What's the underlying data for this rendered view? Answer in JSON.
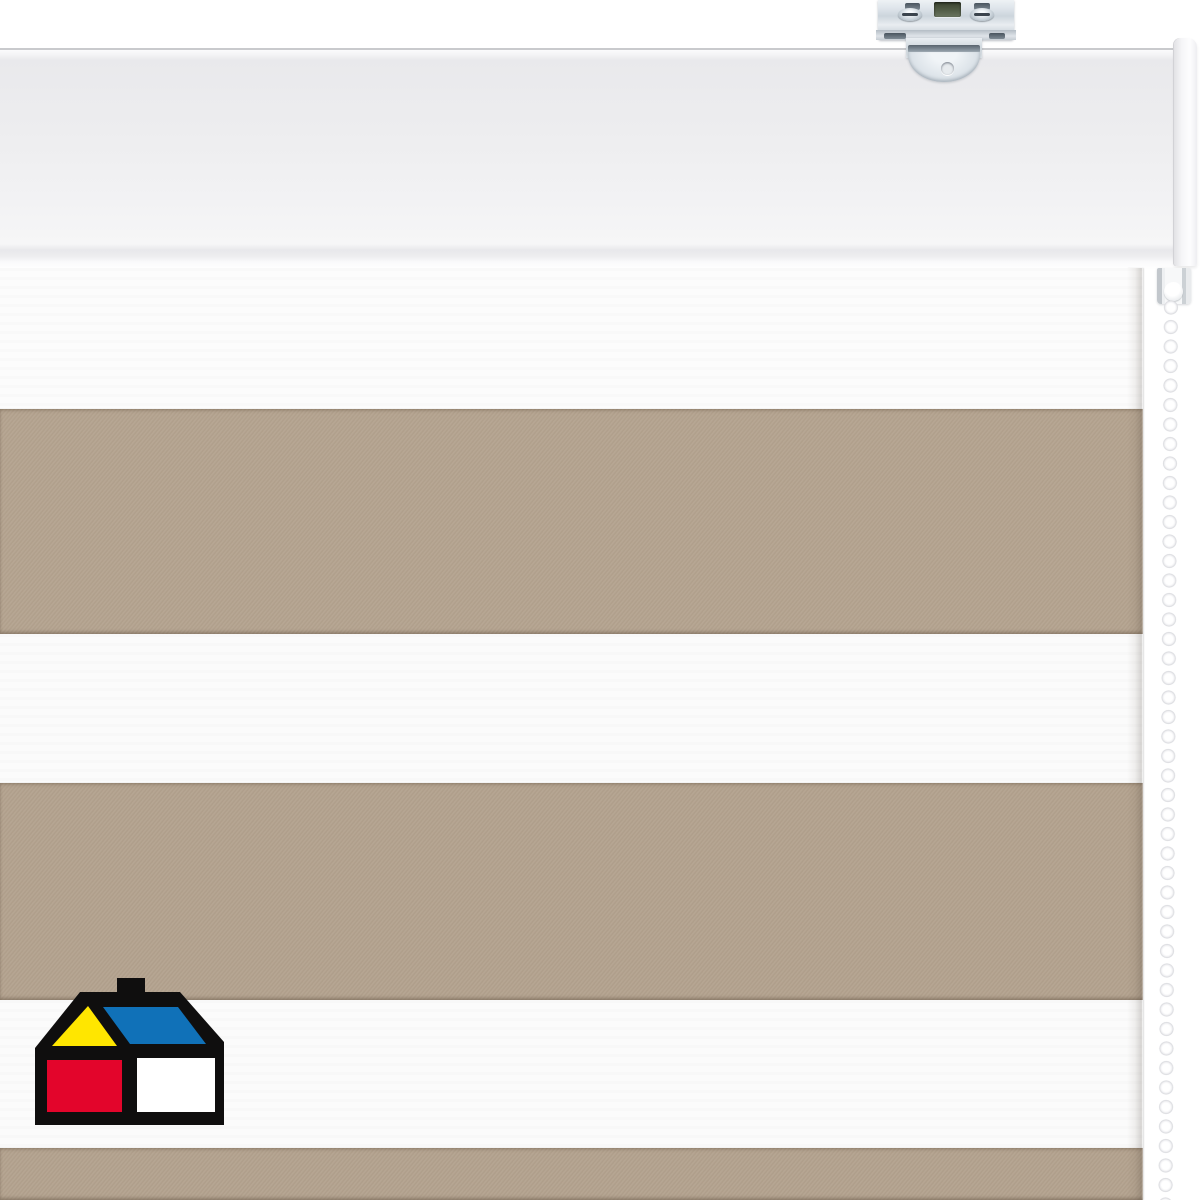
{
  "scene": {
    "subject": "day-night zebra roller blind, white head rail, steel ceiling bracket, white bead chain",
    "background_color": "#ffffff"
  },
  "headrail": {
    "face_color": "#ededef",
    "top_edge_color": "#c9cacd",
    "endcap_color": "#fafafb"
  },
  "bracket": {
    "metal_color": "#d7dee4",
    "slot_color": "#5a656f",
    "center_hole_color": "#4c5741"
  },
  "blind": {
    "top": 268,
    "right_edge": 1143,
    "stripe_colors": {
      "sheer": "#fcfcfc",
      "solid": "#b3a28e"
    },
    "bands": [
      {
        "type": "sheer",
        "from": 268,
        "to": 409,
        "color": "#fcfcfc"
      },
      {
        "type": "solid",
        "from": 409,
        "to": 634,
        "color": "#b3a28e"
      },
      {
        "type": "sheer",
        "from": 634,
        "to": 783,
        "color": "#fbfbfb"
      },
      {
        "type": "solid",
        "from": 783,
        "to": 1000,
        "color": "#b2a18d"
      },
      {
        "type": "sheer",
        "from": 1000,
        "to": 1148,
        "color": "#fbfbfb"
      },
      {
        "type": "solid",
        "from": 1148,
        "to": 1200,
        "color": "#b2a18d"
      }
    ]
  },
  "chain": {
    "bead_color": "#ffffff",
    "bead_mid_color": "#f3f3f5",
    "bead_edge_color": "#d9dade",
    "bead_pitch": 19.5
  },
  "logo": {
    "name": "homecenter-house-logo",
    "colors": {
      "outline": "#0f0e0e",
      "roof_left": "#ffe600",
      "roof_right": "#1071b8",
      "wall_left": "#e3052b",
      "wall_right": "#ffffff"
    }
  }
}
